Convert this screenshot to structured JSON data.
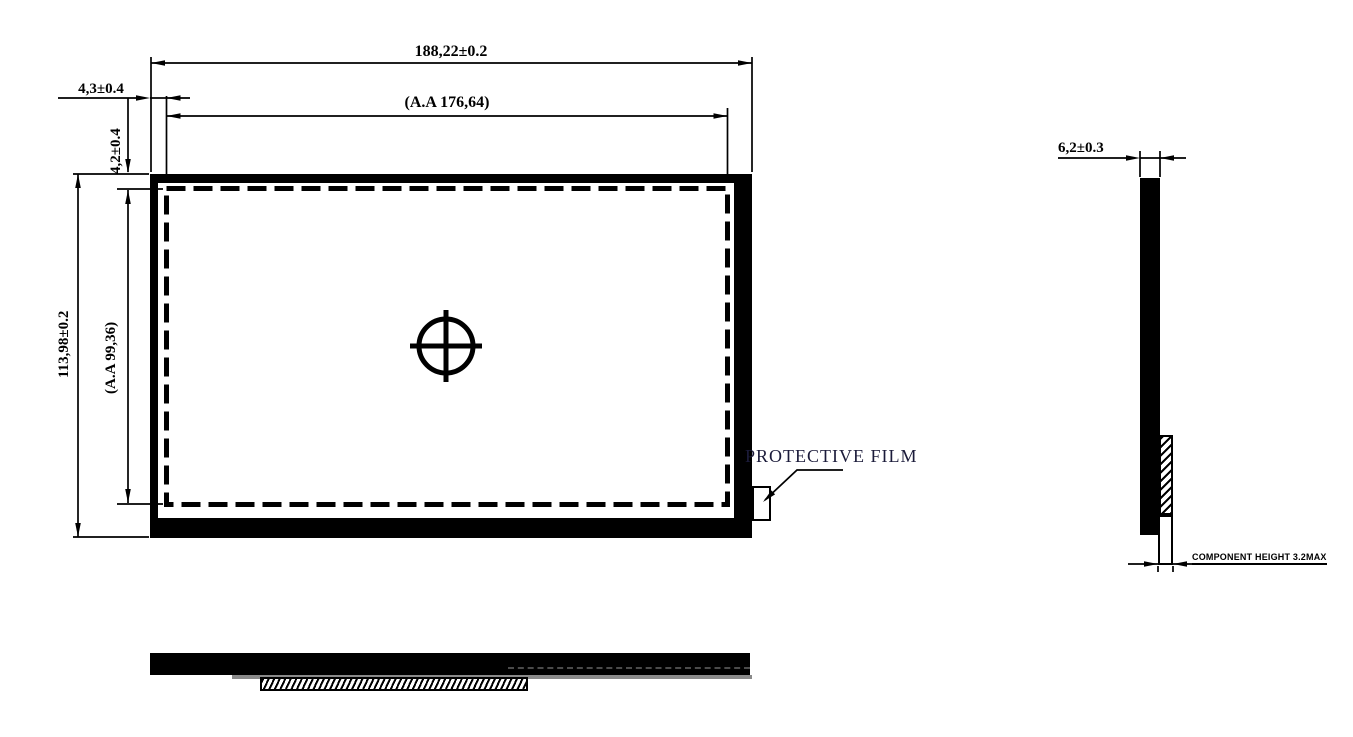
{
  "drawing": {
    "front_view": {
      "width_dim": "188,22±0.2",
      "active_width_dim": "(A.A 176,64)",
      "left_border_dim": "4,3±0.4",
      "top_border_dim": "4,2±0.4",
      "height_dim": "113,98±0.2",
      "active_height_dim": "(A.A 99,36)",
      "protective_film_label": "PROTECTIVE FILM"
    },
    "side_view": {
      "thickness_dim": "6,2±0.3",
      "component_height_note": "COMPONENT HEIGHT 3.2MAX"
    },
    "colors": {
      "line": "#000000",
      "film_label": "#1b1b3a",
      "shadow_gray": "#8a8a8a",
      "background": "#ffffff"
    }
  }
}
